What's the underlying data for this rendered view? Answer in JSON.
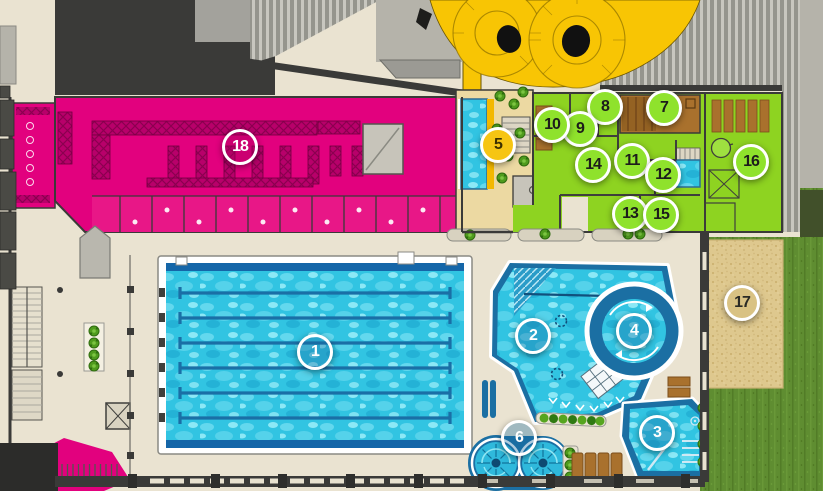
{
  "canvas": {
    "width": 823,
    "height": 491
  },
  "palette": {
    "floor_beige": "#eae3d1",
    "changing_magenta": "#e2017e",
    "wellness_green": "#8ed321",
    "slide_yellow": "#f8c504",
    "sauna_brown": "#a9712d",
    "water_blue": "#31c4e2",
    "pool_edge_blue": "#1b6fa3",
    "sand_tan": "#dec88e",
    "grass_green": "#5f8d31",
    "roof_dark": "#3a3a38",
    "area5_tan": "#ecd9a2"
  },
  "marker_styles": {
    "pool": {
      "fill": "rgba(23,105,160,0.35)",
      "text": "#ffffff"
    },
    "wellness": {
      "fill": "#8fe22c",
      "text": "#1d1d1b"
    },
    "slide": {
      "fill": "#f6c513",
      "text": "#3c3000"
    },
    "outdoor": {
      "fill": "#d9c283",
      "text": "#2b2b25"
    },
    "changing": {
      "fill": "rgba(170,0,95,0.40)",
      "text": "#ffffff"
    }
  },
  "markers": [
    {
      "label": "1",
      "category": "pool",
      "x": 315,
      "y": 352
    },
    {
      "label": "2",
      "category": "pool",
      "x": 533,
      "y": 336
    },
    {
      "label": "3",
      "category": "pool",
      "x": 657,
      "y": 433
    },
    {
      "label": "4",
      "category": "pool",
      "x": 634,
      "y": 331
    },
    {
      "label": "5",
      "category": "slide",
      "x": 498,
      "y": 145
    },
    {
      "label": "6",
      "category": "pool",
      "x": 519,
      "y": 438
    },
    {
      "label": "7",
      "category": "wellness",
      "x": 664,
      "y": 108
    },
    {
      "label": "8",
      "category": "wellness",
      "x": 605,
      "y": 107
    },
    {
      "label": "9",
      "category": "wellness",
      "x": 580,
      "y": 129
    },
    {
      "label": "10",
      "category": "wellness",
      "x": 552,
      "y": 125
    },
    {
      "label": "11",
      "category": "wellness",
      "x": 632,
      "y": 161
    },
    {
      "label": "12",
      "category": "wellness",
      "x": 663,
      "y": 175
    },
    {
      "label": "13",
      "category": "wellness",
      "x": 630,
      "y": 214
    },
    {
      "label": "14",
      "category": "wellness",
      "x": 593,
      "y": 165
    },
    {
      "label": "15",
      "category": "wellness",
      "x": 661,
      "y": 215
    },
    {
      "label": "16",
      "category": "wellness",
      "x": 751,
      "y": 162
    },
    {
      "label": "17",
      "category": "outdoor",
      "x": 742,
      "y": 303
    },
    {
      "label": "18",
      "category": "changing",
      "x": 240,
      "y": 147
    }
  ]
}
